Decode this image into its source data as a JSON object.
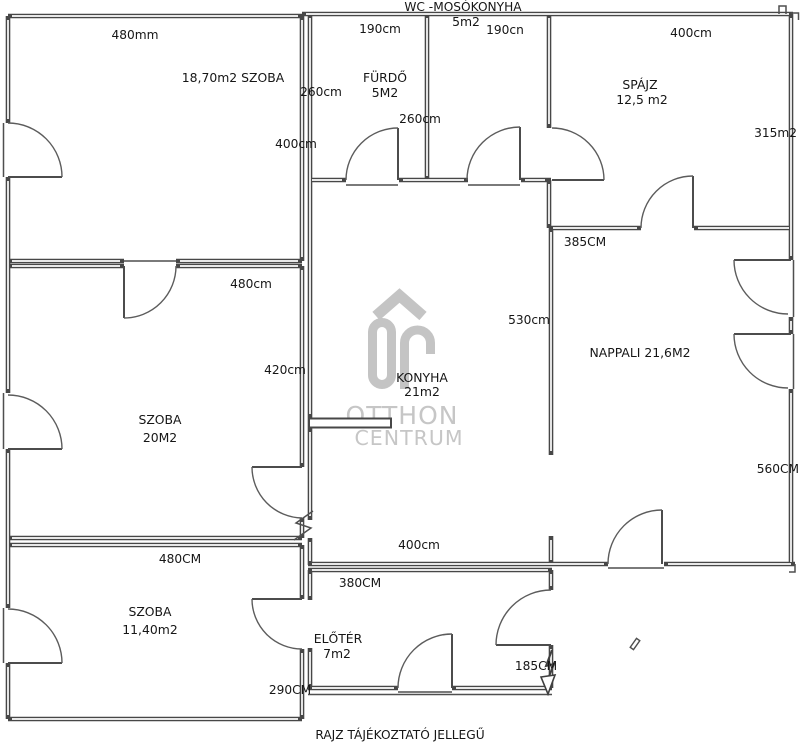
{
  "title": "WC -MOSÓKONYHA",
  "footer": "RAJZ TÁJÉKOZTATÓ JELLEGŰ",
  "watermark": {
    "line1": "OTTHON",
    "line2": "CENTRUM"
  },
  "colors": {
    "wall": "#474747",
    "text": "#161616",
    "watermark": "#c4c4c4",
    "background": "#ffffff"
  },
  "rooms": {
    "szoba_nagy": {
      "label": "18,70m2 SZOBA"
    },
    "furdo": {
      "name": "FÜRDŐ",
      "area": "5M2"
    },
    "wc_mosokonyha": {
      "area": "5m2"
    },
    "spajz": {
      "name": "SPÁJZ",
      "area": "12,5 m2"
    },
    "konyha": {
      "name": "KONYHA",
      "area": "21m2"
    },
    "nappali": {
      "label": "NAPPALI 21,6M2"
    },
    "szoba_kozepso": {
      "name": "SZOBA",
      "area": "20M2"
    },
    "szoba_kis": {
      "name": "SZOBA",
      "area": "11,40m2"
    },
    "eloter": {
      "name": "ELŐTÉR",
      "area": "7m2"
    }
  },
  "dimensions": {
    "szoba_nagy_width": "480mm",
    "szoba_nagy_height": "400cm",
    "furdo_width": "190cm",
    "furdo_height": "260cm",
    "wc_width": "190cn",
    "wc_height": "260cm",
    "spajz_width": "400cm",
    "spajz_height": "315m2",
    "nappali_width": "385CM",
    "nappali_height": "560CM",
    "konyha_width": "400cm",
    "konyha_height": "530cm",
    "szoba_kozepso_width": "480cm",
    "szoba_kozepso_height": "420cm",
    "szoba_kis_width": "480CM",
    "szoba_kis_height": "290CM",
    "eloter_width": "380CM",
    "eloter_height": "185CM"
  }
}
